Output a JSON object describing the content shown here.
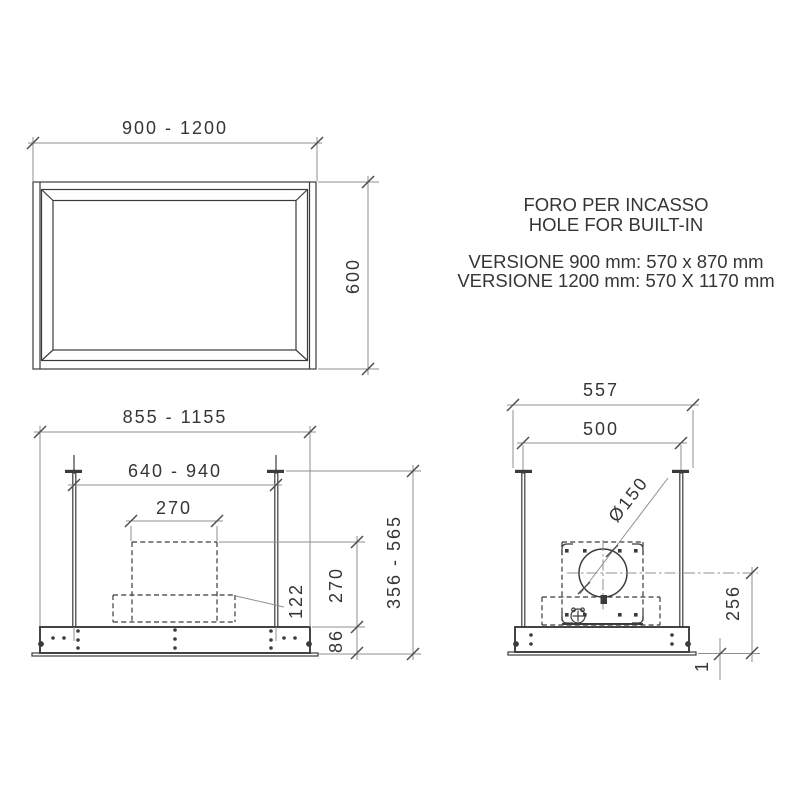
{
  "drawing": {
    "header": {
      "title_line1": "FORO PER INCASSO",
      "title_line2": "HOLE FOR BUILT-IN",
      "version_line1": "VERSIONE 900 mm: 570 x 870 mm",
      "version_line2": "VERSIONE 1200 mm: 570 X 1170 mm"
    },
    "plan_view": {
      "width_range": "900 - 1200",
      "depth": "600"
    },
    "front_view": {
      "overall_width_range": "855 - 1155",
      "hanger_spacing_range": "640 - 940",
      "chimney_width": "270",
      "chimney_height": "270",
      "lower_section_height": "122",
      "body_height": "86",
      "overall_height_range": "356 - 565"
    },
    "side_view": {
      "overall_depth": "557",
      "hanger_spacing": "500",
      "outlet_diameter": "Ø150",
      "outlet_center_height": "256",
      "flange_thickness": "1"
    }
  },
  "colors": {
    "background": "#ffffff",
    "line": "#3b3b3b",
    "dim": "#8f8f8f",
    "tick": "#4d4d4d",
    "text": "#353535"
  }
}
